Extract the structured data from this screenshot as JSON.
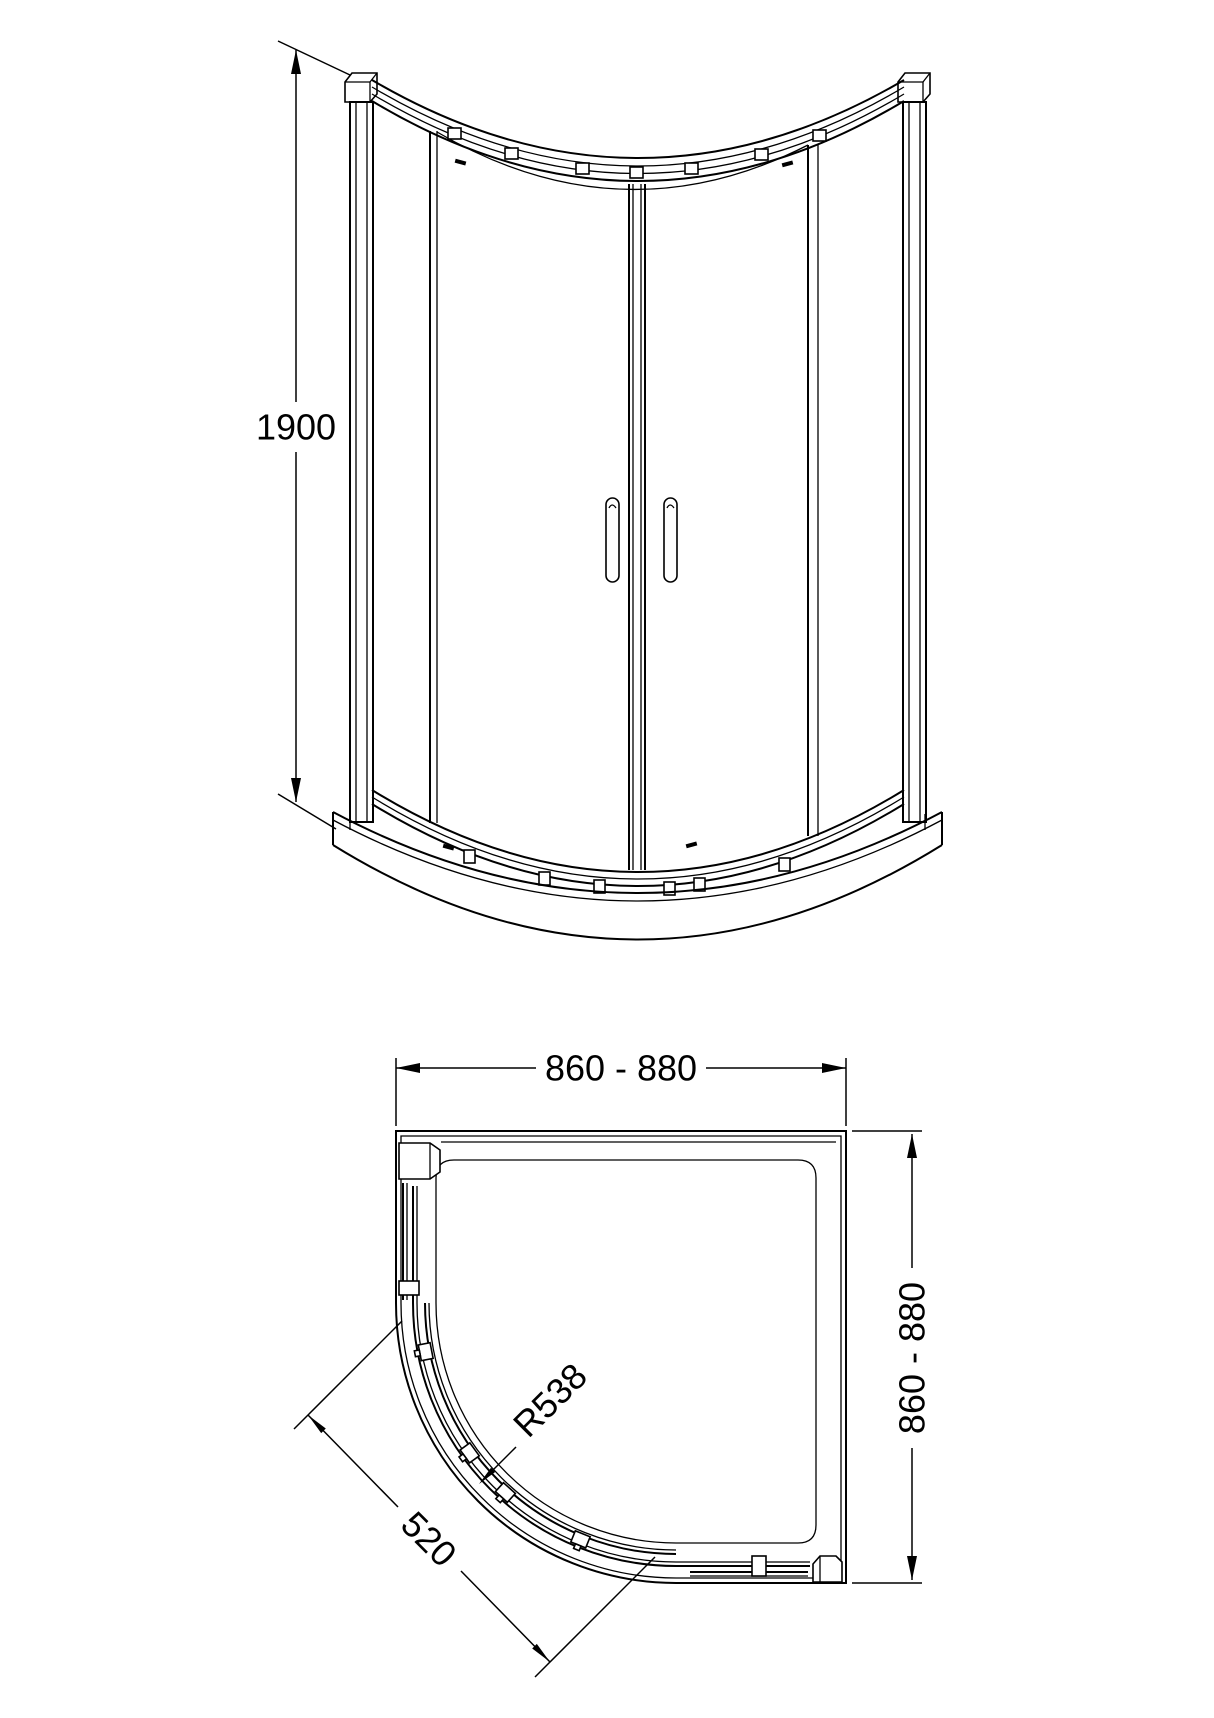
{
  "canvas": {
    "background": "#ffffff",
    "line_color": "#000000"
  },
  "front_elevation": {
    "height_dimension": {
      "label": "1900"
    }
  },
  "plan": {
    "width_dimension": {
      "label": "860 - 880"
    },
    "depth_dimension": {
      "label": "860 - 880"
    },
    "radius_callout": {
      "label": "R538"
    },
    "door_opening_dimension": {
      "label": "520"
    }
  }
}
